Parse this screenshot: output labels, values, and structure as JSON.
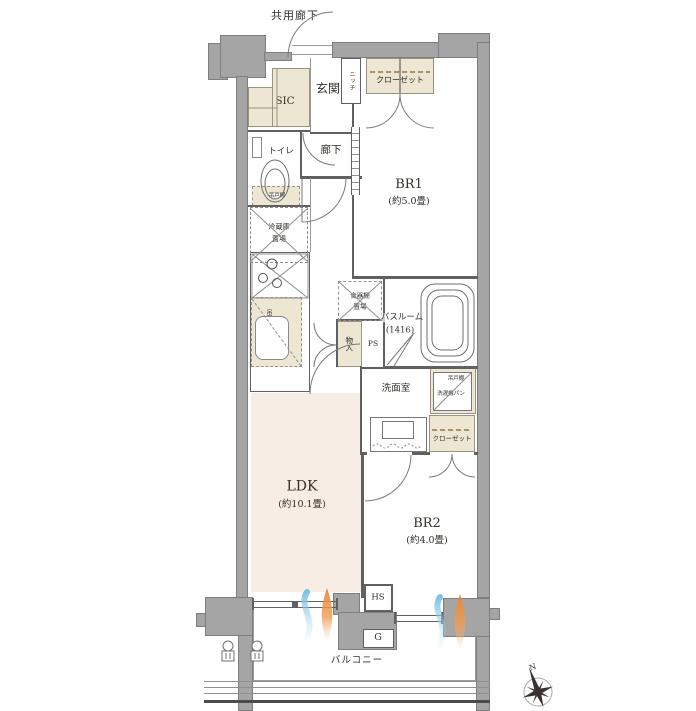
{
  "title": "apartment-floor-plan",
  "colors": {
    "wall": "#a5a5a5",
    "wall_border": "#7e7e7e",
    "closet_fill": "#ece6d2",
    "ldk_floor": "#f7ede4",
    "line": "#606060",
    "flame": "#e8833a",
    "wave": "#6fbde3",
    "hanger_dash": "#a5946a"
  },
  "labels": {
    "common_corridor": "共用廊下",
    "entrance": "玄関",
    "sic": "SIC",
    "niche": "ニッチ",
    "closet_br1": "クローゼット",
    "br1_name": "BR1",
    "br1_size": "(約5.0畳)",
    "toilet": "トイレ",
    "hallway": "廊下",
    "toilet_cabinet": "吊戸棚",
    "fridge_line1": "冷蔵庫",
    "fridge_line2": "置場",
    "kitchen_cabinet": "吊戸棚",
    "dish_line1": "食器棚",
    "dish_line2": "置場",
    "bathroom_name": "バスルーム",
    "bathroom_size": "(1416)",
    "storage": "物入",
    "ps": "PS",
    "washroom": "洗面室",
    "wash_cabinet": "吊戸棚",
    "washer_pan": "洗濯機パン",
    "closet_br2": "クローゼット",
    "ldk_name": "LDK",
    "ldk_size": "(約10.1畳)",
    "br2_name": "BR2",
    "br2_size": "(約4.0畳)",
    "hs": "HS",
    "g": "G",
    "balcony": "バルコニー",
    "compass_north": "N"
  }
}
